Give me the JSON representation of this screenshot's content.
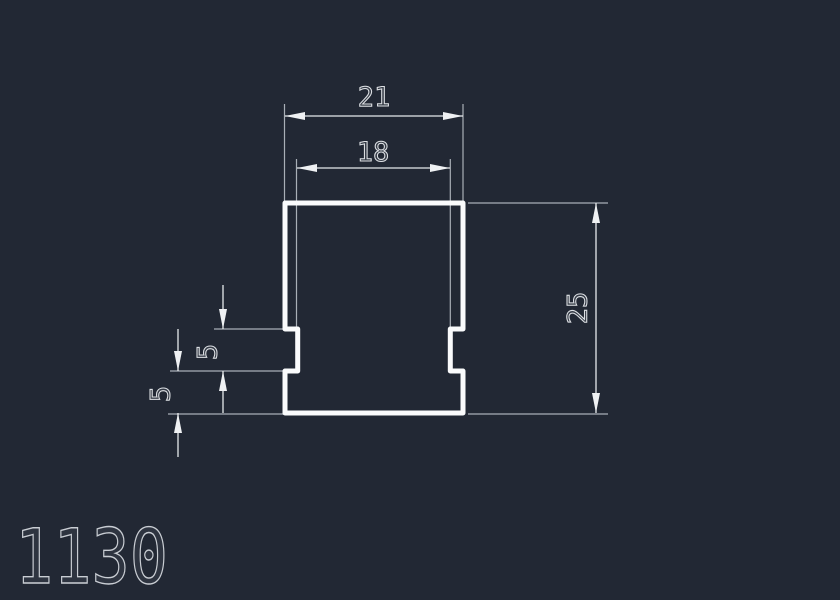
{
  "canvas": {
    "background_color": "#222834",
    "type": "cad-profile-drawing"
  },
  "drawing": {
    "number": "1130",
    "colors": {
      "profile_line": "#fafbfc",
      "dimension_line": "#e6e9ec",
      "extension_line": "#a9afb7"
    },
    "dimensions": {
      "outer_width": "21",
      "inner_width": "18",
      "overall_height": "25",
      "notch_height": "5",
      "base_height": "5"
    }
  }
}
